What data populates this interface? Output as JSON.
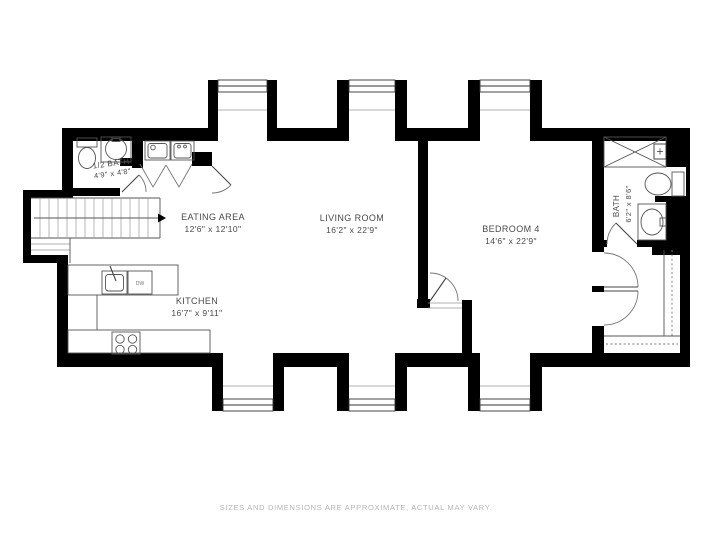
{
  "rooms": {
    "half_bath": {
      "name": "1/2 BATH",
      "dims": "4'9\" x 4'8\""
    },
    "eating": {
      "name": "EATING AREA",
      "dims": "12'6\" x 12'10\""
    },
    "living": {
      "name": "LIVING ROOM",
      "dims": "16'2\" x 22'9\""
    },
    "bedroom": {
      "name": "BEDROOM 4",
      "dims": "14'6\" x 22'9\""
    },
    "bath": {
      "name": "BATH",
      "dims": "6'2\" x 8'6\""
    },
    "kitchen": {
      "name": "KITCHEN",
      "dims": "16'7\" x 9'11\""
    }
  },
  "fixtures": {
    "dishwasher": "DW"
  },
  "footer": {
    "text": "SIZES AND DIMENSIONS ARE APPROXIMATE, ACTUAL MAY VARY."
  },
  "colors": {
    "wall": "#000000",
    "background": "#ffffff",
    "line": "#555555",
    "label": "#4a4a4a",
    "footer": "#b5b5b5"
  }
}
